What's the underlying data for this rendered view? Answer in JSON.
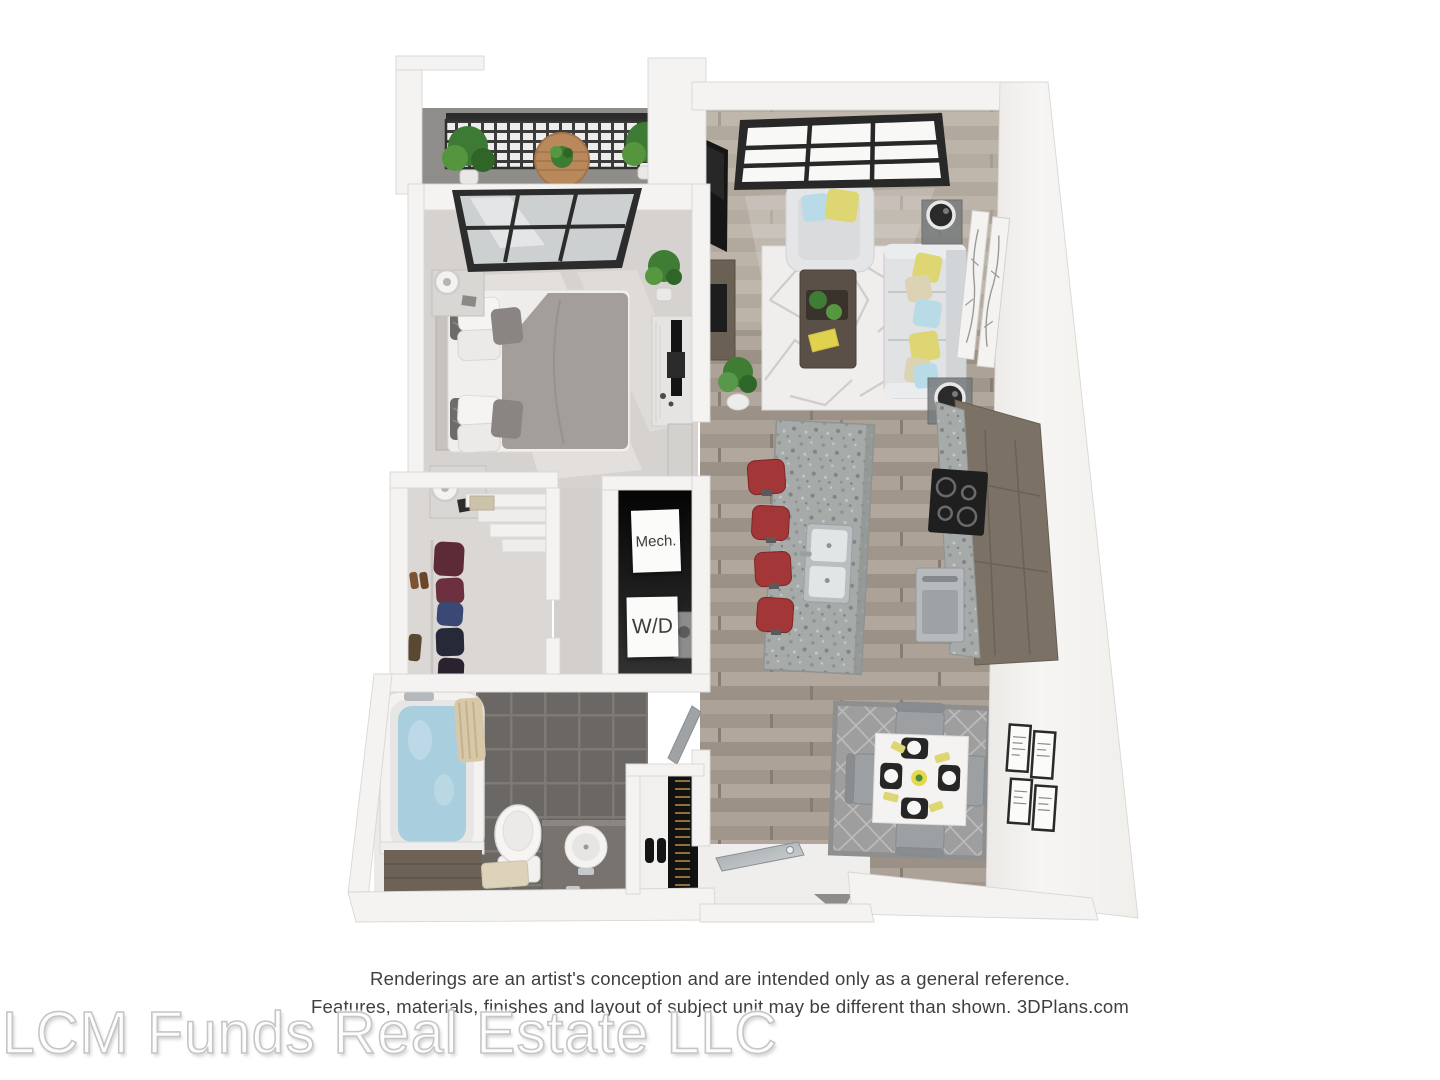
{
  "watermark": "LCM Funds Real Estate LLC",
  "disclaimer": {
    "line1": "Renderings are an artist's conception and are intended only as a general reference.",
    "line2": "Features, materials, finishes and layout of subject unit may be different than shown. 3DPlans.com"
  },
  "floorplan": {
    "closet_labels": {
      "mech": "Mech.",
      "wd": "W/D"
    },
    "accent_colors": {
      "wall": "#f4f3f1",
      "wood_floor": "#a79d93",
      "bedroom_carpet": "#d6d2cf",
      "bathroom_tile": "#6b6764",
      "granite_counter": "#a4a8a7",
      "cabinet_taupe": "#7b7265",
      "bar_stool_red": "#a33636",
      "pillow_yellow": "#ddd672",
      "pillow_blue": "#b9dbe7",
      "plant_green": "#4a8a3c",
      "tub_water_blue": "#a9cede",
      "sofa_gray": "#e0e2e4",
      "balcony_rail_dark": "#2f2f2f"
    }
  }
}
